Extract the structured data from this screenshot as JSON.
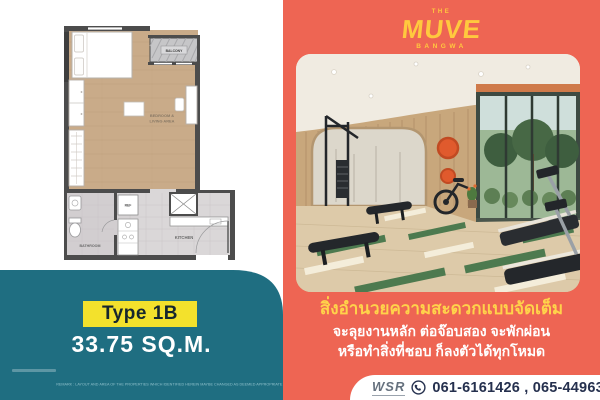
{
  "left_panel": {
    "floorplan": {
      "balcony_label": "BALCONY",
      "bedroom_living_label_1": "BEDROOM &",
      "bedroom_living_label_2": "LIVING AREA",
      "ref_label": "REF",
      "bathroom_label": "BATHROOM",
      "kitchen_label": "KITCHEN"
    },
    "type_badge": "Type 1B",
    "area": "33.75 SQ.M.",
    "disclaimer": "REMARK : LAYOUT AND AREA OF THE PROPERTIES WHICH IDENTIFIED HEREIN MAYBE CHANGED AS DEEMED APPROPRIATE BUT WILL NOT IMPACT UPON THE USE.",
    "colors": {
      "teal": "#1f6e81",
      "badge_yellow": "#f3e12c",
      "badge_text": "#16262e"
    }
  },
  "right_panel": {
    "logo": {
      "the": "THE",
      "name": "MUVE",
      "sub": "BANGWA"
    },
    "headline": "สิ่งอำนวยความสะดวกแบบจัดเต็ม",
    "subline1": "จะลุยงานหลัก ต่อจ๊อบสอง จะพักผ่อน",
    "subline2": "หรือทำสิ่งที่ชอบ ก็ลงตัวได้ทุกโหมด",
    "contact": {
      "brand": "WSR",
      "phones": "061-6161426 , 065-4496399"
    },
    "colors": {
      "coral": "#ee6553",
      "logo_yellow": "#ffc93e",
      "headline_yellow": "#ffd34a",
      "phone_navy": "#25304e"
    }
  }
}
